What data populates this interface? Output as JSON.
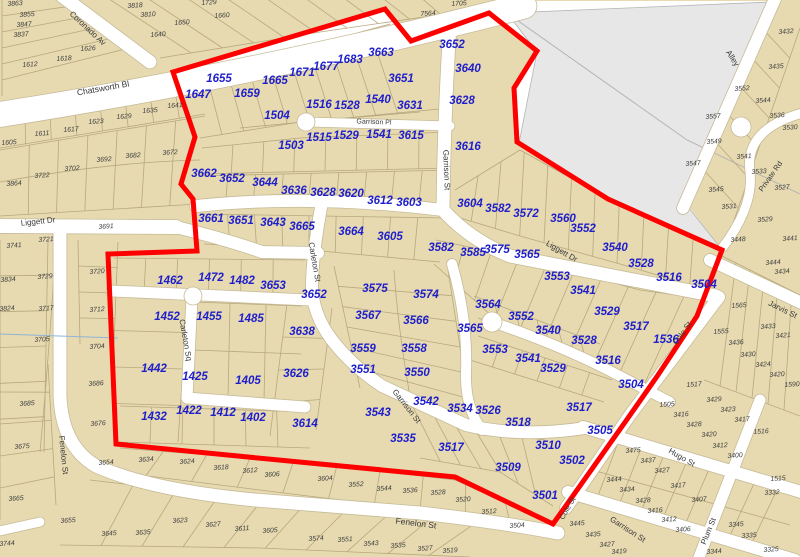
{
  "map": {
    "colors": {
      "parcel": "#e7dab1",
      "lot_line": "#b7a87e",
      "street": "#ffffff",
      "street_edge": "#c6bb97",
      "gray_area": "#e7e7e7",
      "gray_edge": "#b5b5b5",
      "boundary": "#ff0000",
      "selected_label": "#1e1ecb",
      "parcel_label": "#3b3b3b",
      "street_label": "#383838",
      "contour": "#8fb4d8"
    },
    "selected_parcels": [
      [
        "1647",
        198,
        94
      ],
      [
        "1655",
        219,
        78
      ],
      [
        "1659",
        247,
        93
      ],
      [
        "1665",
        275,
        80
      ],
      [
        "1671",
        302,
        72
      ],
      [
        "1677",
        326,
        66
      ],
      [
        "1683",
        350,
        59
      ],
      [
        "3663",
        381,
        52
      ],
      [
        "3651",
        401,
        78
      ],
      [
        "3652",
        452,
        44
      ],
      [
        "3640",
        468,
        68
      ],
      [
        "3628",
        462,
        100
      ],
      [
        "3616",
        468,
        146
      ],
      [
        "1516",
        319,
        104
      ],
      [
        "1528",
        347,
        105
      ],
      [
        "1540",
        378,
        99
      ],
      [
        "3631",
        410,
        105
      ],
      [
        "1504",
        277,
        115
      ],
      [
        "1503",
        291,
        145
      ],
      [
        "1515",
        319,
        137
      ],
      [
        "1529",
        346,
        135
      ],
      [
        "1541",
        379,
        134
      ],
      [
        "3615",
        411,
        135
      ],
      [
        "3662",
        204,
        173
      ],
      [
        "3652",
        232,
        178
      ],
      [
        "3644",
        265,
        182
      ],
      [
        "3636",
        294,
        190
      ],
      [
        "3628",
        323,
        192
      ],
      [
        "3620",
        351,
        193
      ],
      [
        "3612",
        380,
        200
      ],
      [
        "3603",
        409,
        202
      ],
      [
        "3661",
        211,
        218
      ],
      [
        "3651",
        241,
        220
      ],
      [
        "3643",
        273,
        222
      ],
      [
        "3665",
        302,
        226
      ],
      [
        "3664",
        351,
        231
      ],
      [
        "3605",
        390,
        236
      ],
      [
        "3604",
        470,
        203
      ],
      [
        "3582",
        498,
        208
      ],
      [
        "3572",
        526,
        213
      ],
      [
        "3560",
        563,
        218
      ],
      [
        "3552",
        583,
        228
      ],
      [
        "3540",
        615,
        247
      ],
      [
        "3528",
        641,
        263
      ],
      [
        "3516",
        669,
        277
      ],
      [
        "3504",
        704,
        284
      ],
      [
        "3582",
        441,
        247
      ],
      [
        "3585",
        473,
        252
      ],
      [
        "3575",
        497,
        249
      ],
      [
        "3565",
        527,
        254
      ],
      [
        "3553",
        557,
        276
      ],
      [
        "3541",
        583,
        290
      ],
      [
        "3529",
        607,
        311
      ],
      [
        "3517",
        636,
        326
      ],
      [
        "1536",
        666,
        339
      ],
      [
        "3516",
        608,
        360
      ],
      [
        "3504",
        631,
        384
      ],
      [
        "1462",
        170,
        280
      ],
      [
        "1472",
        211,
        277
      ],
      [
        "1482",
        242,
        280
      ],
      [
        "3653",
        273,
        285
      ],
      [
        "3652",
        314,
        294
      ],
      [
        "3575",
        375,
        288
      ],
      [
        "3574",
        426,
        294
      ],
      [
        "1452",
        167,
        316
      ],
      [
        "1455",
        209,
        316
      ],
      [
        "1485",
        251,
        318
      ],
      [
        "3638",
        302,
        331
      ],
      [
        "3567",
        368,
        315
      ],
      [
        "3566",
        416,
        320
      ],
      [
        "3564",
        488,
        304
      ],
      [
        "3552",
        521,
        316
      ],
      [
        "3540",
        548,
        330
      ],
      [
        "3528",
        584,
        340
      ],
      [
        "3565",
        470,
        328
      ],
      [
        "3553",
        495,
        349
      ],
      [
        "3541",
        528,
        358
      ],
      [
        "3529",
        553,
        368
      ],
      [
        "3559",
        363,
        348
      ],
      [
        "3558",
        414,
        348
      ],
      [
        "3551",
        363,
        369
      ],
      [
        "3550",
        417,
        372
      ],
      [
        "1442",
        154,
        368
      ],
      [
        "1425",
        195,
        376
      ],
      [
        "1405",
        248,
        380
      ],
      [
        "3626",
        296,
        373
      ],
      [
        "1432",
        154,
        416
      ],
      [
        "1422",
        189,
        410
      ],
      [
        "1412",
        223,
        412
      ],
      [
        "1402",
        253,
        417
      ],
      [
        "3614",
        305,
        423
      ],
      [
        "3543",
        378,
        412
      ],
      [
        "3542",
        426,
        401
      ],
      [
        "3534",
        460,
        408
      ],
      [
        "3526",
        488,
        410
      ],
      [
        "3518",
        518,
        422
      ],
      [
        "3535",
        403,
        438
      ],
      [
        "3517",
        451,
        447
      ],
      [
        "3517",
        579,
        407
      ],
      [
        "3510",
        548,
        445
      ],
      [
        "3509",
        508,
        467
      ],
      [
        "3505",
        600,
        430
      ],
      [
        "3502",
        572,
        460
      ],
      [
        "3501",
        545,
        495
      ]
    ],
    "parcels": [
      [
        "3863",
        15,
        3
      ],
      [
        "3855",
        27,
        14
      ],
      [
        "3847",
        24,
        24
      ],
      [
        "3837",
        21,
        34
      ],
      [
        "1626",
        88,
        48
      ],
      [
        "1618",
        64,
        58
      ],
      [
        "1612",
        30,
        64
      ],
      [
        "3818",
        135,
        5
      ],
      [
        "3810",
        148,
        14
      ],
      [
        "1650",
        182,
        22
      ],
      [
        "1640",
        158,
        34
      ],
      [
        "1660",
        222,
        15
      ],
      [
        "1729",
        209,
        2
      ],
      [
        "1705",
        459,
        3
      ],
      [
        "7564",
        428,
        13
      ],
      [
        "1605",
        9,
        142
      ],
      [
        "1611",
        42,
        133
      ],
      [
        "1617",
        71,
        129
      ],
      [
        "1623",
        96,
        121
      ],
      [
        "1629",
        124,
        116
      ],
      [
        "1635",
        150,
        110
      ],
      [
        "1641",
        175,
        105
      ],
      [
        "3692",
        104,
        159
      ],
      [
        "3682",
        133,
        155
      ],
      [
        "3672",
        170,
        152
      ],
      [
        "3702",
        72,
        168
      ],
      [
        "3722",
        42,
        175
      ],
      [
        "3864",
        14,
        183
      ],
      [
        "3741",
        14,
        245
      ],
      [
        "3721",
        46,
        239
      ],
      [
        "3691",
        106,
        226
      ],
      [
        "3834",
        8,
        279
      ],
      [
        "3729",
        45,
        276
      ],
      [
        "3720",
        97,
        271
      ],
      [
        "3824",
        7,
        308
      ],
      [
        "3717",
        46,
        308
      ],
      [
        "3712",
        97,
        309
      ],
      [
        "3705",
        42,
        339
      ],
      [
        "3704",
        97,
        346
      ],
      [
        "3685",
        27,
        403
      ],
      [
        "3675",
        22,
        446
      ],
      [
        "3665",
        16,
        498
      ],
      [
        "3686",
        96,
        383
      ],
      [
        "3676",
        98,
        423
      ],
      [
        "3654",
        106,
        462
      ],
      [
        "3634",
        146,
        459
      ],
      [
        "3624",
        187,
        461
      ],
      [
        "3618",
        221,
        467
      ],
      [
        "3612",
        250,
        470
      ],
      [
        "3606",
        272,
        474
      ],
      [
        "3744",
        7,
        543
      ],
      [
        "3655",
        68,
        520
      ],
      [
        "3645",
        109,
        533
      ],
      [
        "3635",
        143,
        532
      ],
      [
        "3623",
        180,
        520
      ],
      [
        "3627",
        213,
        524
      ],
      [
        "3611",
        242,
        528
      ],
      [
        "3605",
        270,
        530
      ],
      [
        "3604",
        325,
        478
      ],
      [
        "3552",
        356,
        484
      ],
      [
        "3544",
        384,
        488
      ],
      [
        "3536",
        410,
        490
      ],
      [
        "3528",
        438,
        492
      ],
      [
        "3520",
        463,
        499
      ],
      [
        "3512",
        489,
        511
      ],
      [
        "3504",
        517,
        525
      ],
      [
        "3574",
        316,
        538
      ],
      [
        "3551",
        345,
        539
      ],
      [
        "3543",
        371,
        543
      ],
      [
        "3535",
        398,
        545
      ],
      [
        "3527",
        425,
        548
      ],
      [
        "3519",
        450,
        550
      ],
      [
        "3445",
        577,
        523
      ],
      [
        "3435",
        593,
        534
      ],
      [
        "3427",
        607,
        544
      ],
      [
        "3419",
        619,
        551
      ],
      [
        "3475",
        633,
        450
      ],
      [
        "3437",
        648,
        460
      ],
      [
        "3427",
        662,
        470
      ],
      [
        "3444",
        614,
        479
      ],
      [
        "3434",
        627,
        489
      ],
      [
        "3428",
        643,
        500
      ],
      [
        "3416",
        655,
        510
      ],
      [
        "3412",
        669,
        519
      ],
      [
        "3406",
        683,
        529
      ],
      [
        "3417",
        678,
        485
      ],
      [
        "3407",
        699,
        499
      ],
      [
        "3345",
        736,
        524
      ],
      [
        "3335",
        749,
        535
      ],
      [
        "3325",
        771,
        549
      ],
      [
        "3344",
        714,
        551
      ],
      [
        "3332",
        772,
        492
      ],
      [
        "1515",
        778,
        478
      ],
      [
        "1517",
        694,
        384
      ],
      [
        "1505",
        667,
        404
      ],
      [
        "3429",
        714,
        399
      ],
      [
        "3423",
        728,
        409
      ],
      [
        "3417",
        742,
        419
      ],
      [
        "3416",
        681,
        414
      ],
      [
        "3428",
        694,
        424
      ],
      [
        "3420",
        709,
        434
      ],
      [
        "3412",
        720,
        445
      ],
      [
        "3400",
        735,
        455
      ],
      [
        "1516",
        761,
        431
      ],
      [
        "1590",
        792,
        384
      ],
      [
        "1565",
        739,
        305
      ],
      [
        "1555",
        721,
        331
      ],
      [
        "3433",
        768,
        326
      ],
      [
        "3421",
        783,
        335
      ],
      [
        "3436",
        736,
        342
      ],
      [
        "3430",
        748,
        354
      ],
      [
        "3424",
        763,
        364
      ],
      [
        "3420",
        777,
        374
      ],
      [
        "3444",
        773,
        262
      ],
      [
        "3434",
        782,
        271
      ],
      [
        "3448",
        738,
        239
      ],
      [
        "3441",
        790,
        238
      ],
      [
        "3531",
        729,
        206
      ],
      [
        "3529",
        765,
        219
      ],
      [
        "3432",
        786,
        31
      ],
      [
        "3435",
        776,
        66
      ],
      [
        "3552",
        742,
        88
      ],
      [
        "3544",
        763,
        100
      ],
      [
        "3536",
        777,
        115
      ],
      [
        "3530",
        790,
        127
      ],
      [
        "3557",
        713,
        116
      ],
      [
        "3549",
        714,
        141
      ],
      [
        "3541",
        744,
        156
      ],
      [
        "3547",
        693,
        163
      ],
      [
        "3533",
        759,
        171
      ],
      [
        "3545",
        716,
        189
      ],
      [
        "3527",
        782,
        187
      ]
    ],
    "street_labels": [
      [
        "Coronado Av",
        88,
        28,
        43,
        8
      ],
      [
        "Chatsworth Bl",
        103,
        88,
        -10,
        8.5
      ],
      [
        "Liggett Dr",
        38,
        221,
        -6,
        8
      ],
      [
        "Garrison Pl",
        374,
        121,
        2,
        7
      ],
      [
        "Garrison St",
        447,
        170,
        88,
        8
      ],
      [
        "Carleton St",
        315,
        262,
        80,
        8
      ],
      [
        "Carleton Sq",
        186,
        340,
        80,
        8
      ],
      [
        "Liggett Dr",
        562,
        251,
        30,
        8
      ],
      [
        "Garrison St",
        407,
        406,
        52,
        8
      ],
      [
        "Fenelon St",
        64,
        455,
        84,
        8
      ],
      [
        "Fenelon St",
        416,
        523,
        7,
        8.5
      ],
      [
        "Garrison St",
        628,
        529,
        33,
        8
      ],
      [
        "Hugo St",
        682,
        457,
        30,
        8
      ],
      [
        "Plum St",
        708,
        531,
        -68,
        8
      ],
      [
        "Cole St",
        682,
        333,
        -55,
        8
      ],
      [
        "Cole St",
        567,
        508,
        -60,
        7.5
      ],
      [
        "Jarvis St",
        783,
        309,
        26,
        8
      ],
      [
        "Private Rd",
        770,
        176,
        -55,
        7.5
      ],
      [
        "Alley",
        733,
        58,
        57,
        8
      ]
    ]
  }
}
